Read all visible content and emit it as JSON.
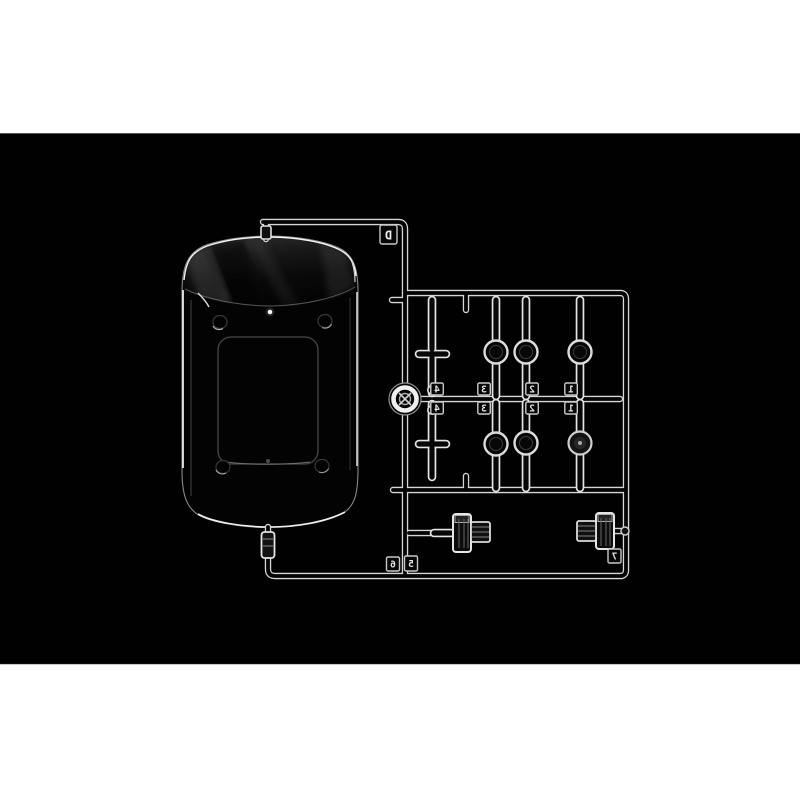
{
  "photo": {
    "alt": "Clear plastic model kit sprue D: cab roof window panel, six round lamp lenses, headlight ring and two rectangular ribbed lamp lenses, photographed on black",
    "canvas_background": "#ffffff",
    "photo_background": "#010101",
    "plastic_edge_color": "#d9d9d9",
    "highlight_color": "#f2f2f2"
  },
  "tags": {
    "gate_letter": "D",
    "upper_numbers": [
      "4",
      "3",
      "2",
      "1"
    ],
    "lower_numbers": [
      "4",
      "3",
      "2",
      "1"
    ],
    "corner_left_numbers": [
      "6",
      "5"
    ],
    "corner_right_number": "7"
  }
}
